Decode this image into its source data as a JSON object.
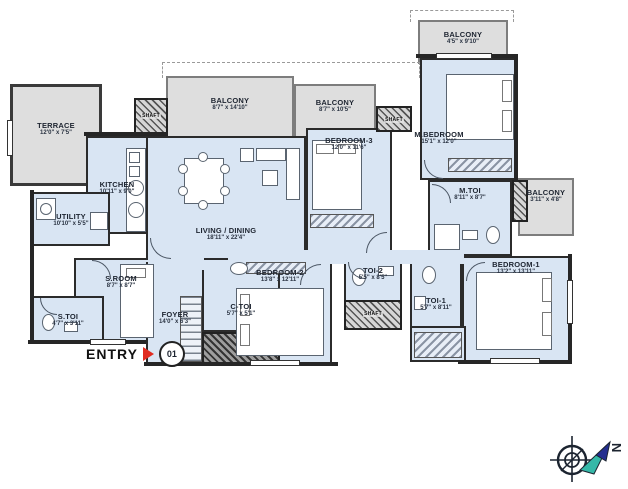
{
  "plan": {
    "title": "apartment-floor-plan",
    "room_fill": "#d9e5f3",
    "balcony_fill": "#dedede",
    "wall_color": "#262626",
    "accent_red": "#e02b20",
    "label_color": "#1d2430",
    "compass_teal": "#35b8a8",
    "compass_navy": "#232e8f",
    "shaft_label": "SHAFT"
  },
  "rooms": [
    {
      "label": "TERRACE",
      "dims": "12'0\" x 7'5\""
    },
    {
      "label": "BALCONY",
      "dims": "8'7\" x 14'10\""
    },
    {
      "label": "BALCONY",
      "dims": "8'7\" x 10'5\""
    },
    {
      "label": "BALCONY",
      "dims": "4'5\" x 9'10\""
    },
    {
      "label": "BALCONY",
      "dims": "3'11\" x 4'8\""
    },
    {
      "label": "KITCHEN",
      "dims": "10'11\" x 9'0\""
    },
    {
      "label": "UTILITY",
      "dims": "10'10\" x 5'5\""
    },
    {
      "label": "LIVING / DINING",
      "dims": "18'11\" x 22'4\""
    },
    {
      "label": "BEDROOM-3",
      "dims": "12'0\" x 11'6\""
    },
    {
      "label": "M.BEDROOM",
      "dims": "15'1\" x 12'0\""
    },
    {
      "label": "M.TOI",
      "dims": "8'11\" x 8'7\""
    },
    {
      "label": "BEDROOM-1",
      "dims": "13'2\" x 13'11\""
    },
    {
      "label": "BEDROOM-2",
      "dims": "13'8\" x 12'11\""
    },
    {
      "label": "S.ROOM",
      "dims": "8'7\" x 8'7\""
    },
    {
      "label": "S.TOI",
      "dims": "4'7\" x 3'11\""
    },
    {
      "label": "FOYER",
      "dims": "14'0\" x 6'3\""
    },
    {
      "label": "C-TOI",
      "dims": "5'7\" x 5'1\""
    },
    {
      "label": "TOI-2",
      "dims": "5'5\" x 8'5\""
    },
    {
      "label": "TOI-1",
      "dims": "5'7\" x 8'11\""
    }
  ],
  "entry": {
    "label": "ENTRY",
    "badge": "01"
  },
  "compass": {
    "north_label": "N"
  }
}
